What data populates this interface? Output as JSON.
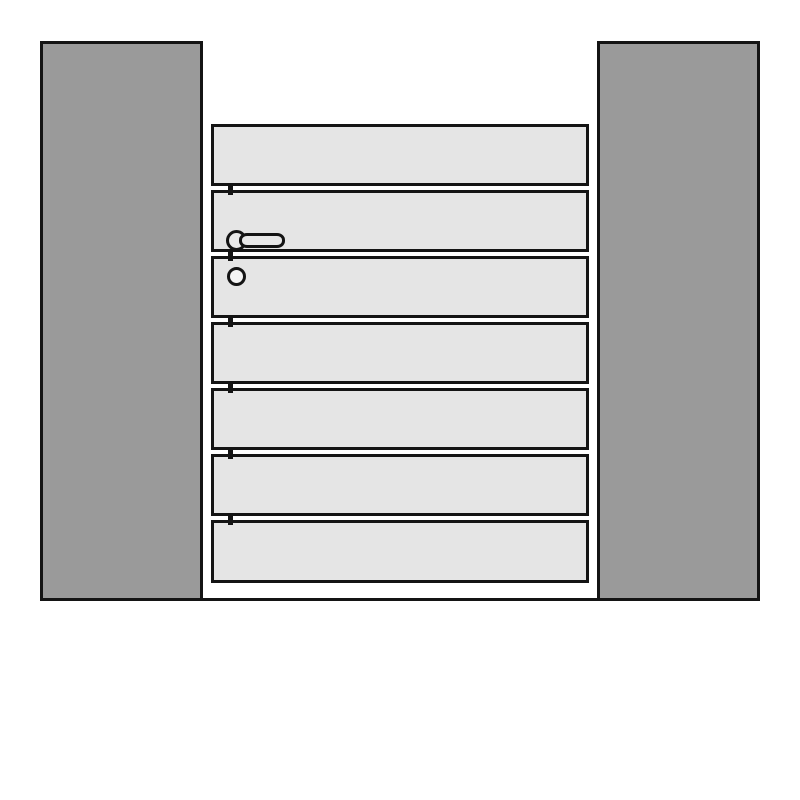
{
  "drawing": {
    "kind": "technical-line-drawing",
    "subject": "single garden gate with horizontal boards mounted between two square posts",
    "posts": {
      "count": 2,
      "items": [
        {
          "side": "left"
        },
        {
          "side": "right"
        }
      ]
    },
    "gate": {
      "board_count": 7,
      "board_orientation": "horizontal",
      "joint_tick_count": 6,
      "hinge_side": "right",
      "handle_side": "left"
    },
    "hardware": {
      "lever_handle": "lever handle on rosette, pointing right, on second board",
      "lock_cylinder": "round cylinder below handle on third board"
    },
    "ground_line": "horizontal base line joining the two post feet"
  },
  "colors": {
    "background": "#ffffff",
    "post_fill": "#9a9a9a",
    "board_fill": "#e5e5e5",
    "outline": "#141414",
    "handle_fill": "#e8e8e8",
    "cylinder_fill": "#f4f4f4"
  }
}
